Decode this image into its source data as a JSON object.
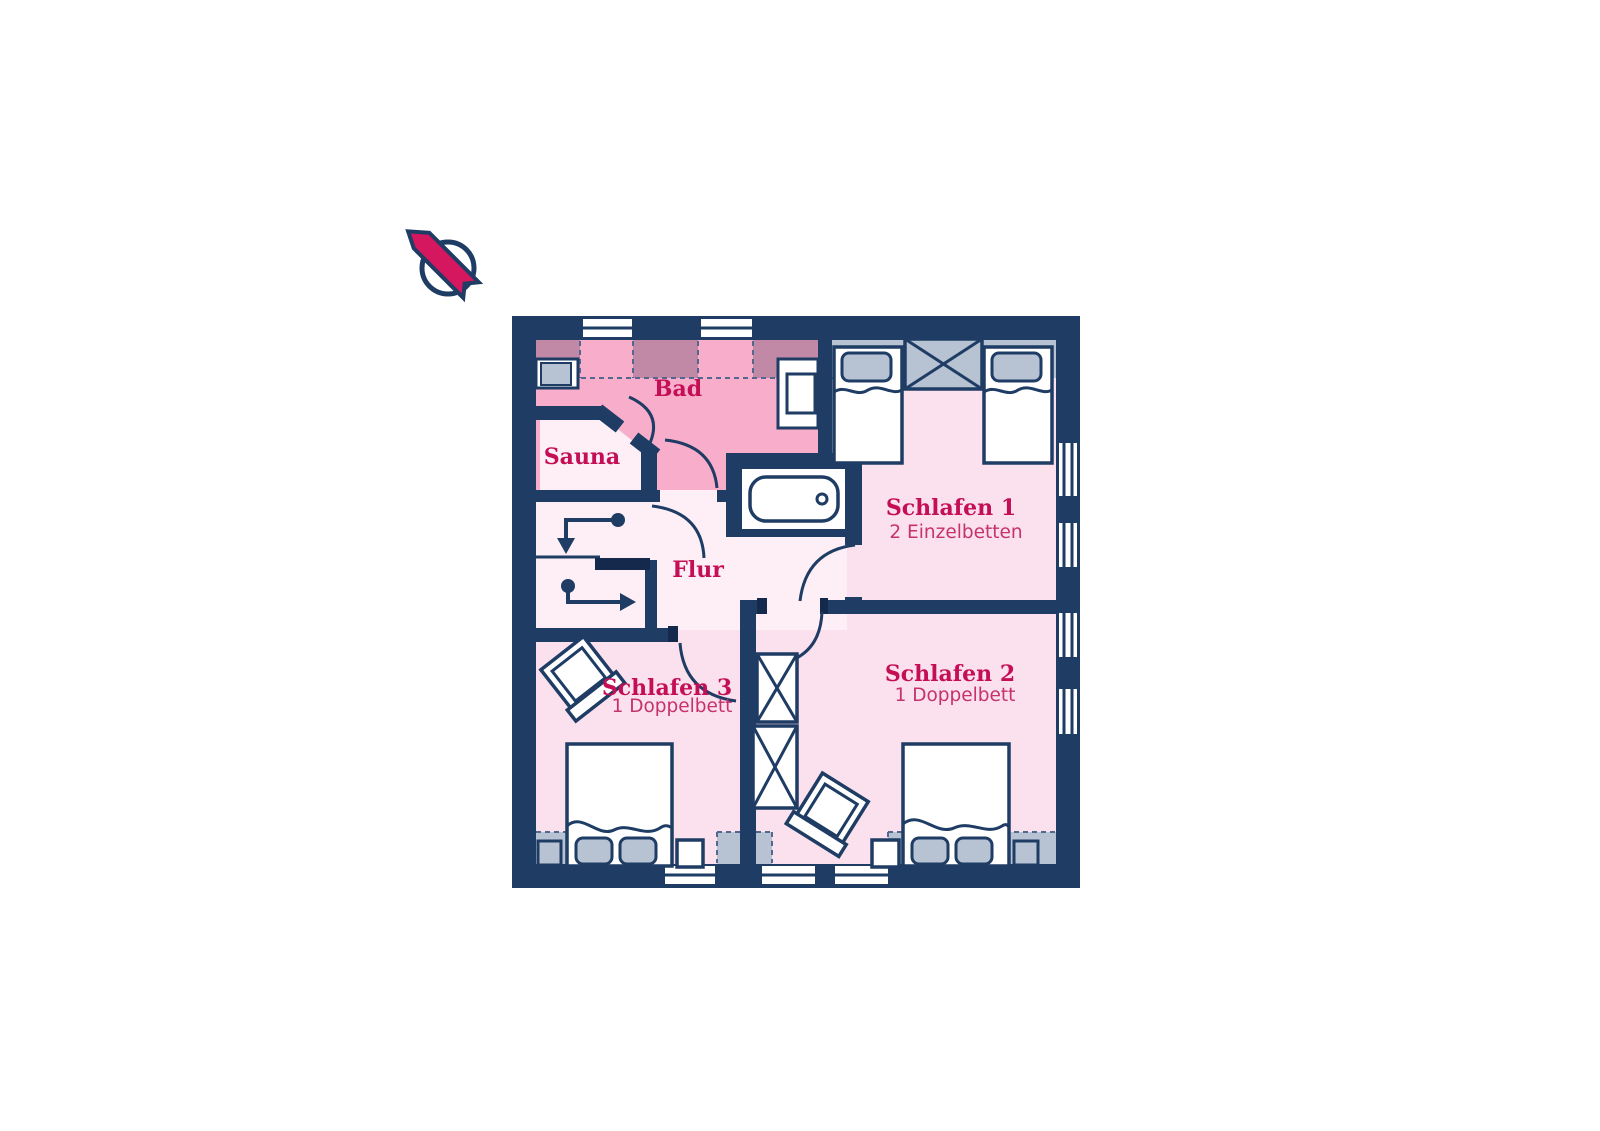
{
  "colors": {
    "navy": "#1e3c64",
    "jamb": "#14294b",
    "pinkStrong": "#f8aeca",
    "pinkLight": "#fbe1ed",
    "pale": "#fdeff5",
    "grayBand": "#b7c2d3",
    "mauve": "#c189a6",
    "dash": "#53688e",
    "crimson": "#c40e56",
    "crimsonSub": "#c5326d",
    "northRibbon": "#d4175e"
  },
  "north_indicator": {
    "icon": "north-arrow"
  },
  "rooms": [
    {
      "id": "bad",
      "label": "Bad",
      "subtitle": "",
      "fixtures": [
        "bathtub",
        "washbasin",
        "shelf"
      ]
    },
    {
      "id": "sauna",
      "label": "Sauna",
      "subtitle": "",
      "fixtures": []
    },
    {
      "id": "flur",
      "label": "Flur",
      "subtitle": "",
      "fixtures": [
        "staircase"
      ]
    },
    {
      "id": "schlafen-1",
      "label": "Schlafen 1",
      "subtitle": "2 Einzelbetten",
      "fixtures": [
        "single-bed",
        "single-bed",
        "wardrobe"
      ]
    },
    {
      "id": "schlafen-2",
      "label": "Schlafen 2",
      "subtitle": "1 Doppelbett",
      "fixtures": [
        "double-bed",
        "wardrobe",
        "wardrobe",
        "chair",
        "nightstand"
      ]
    },
    {
      "id": "schlafen-3",
      "label": "Schlafen 3",
      "subtitle": "1 Doppelbett",
      "fixtures": [
        "double-bed",
        "chair",
        "nightstand"
      ]
    }
  ]
}
